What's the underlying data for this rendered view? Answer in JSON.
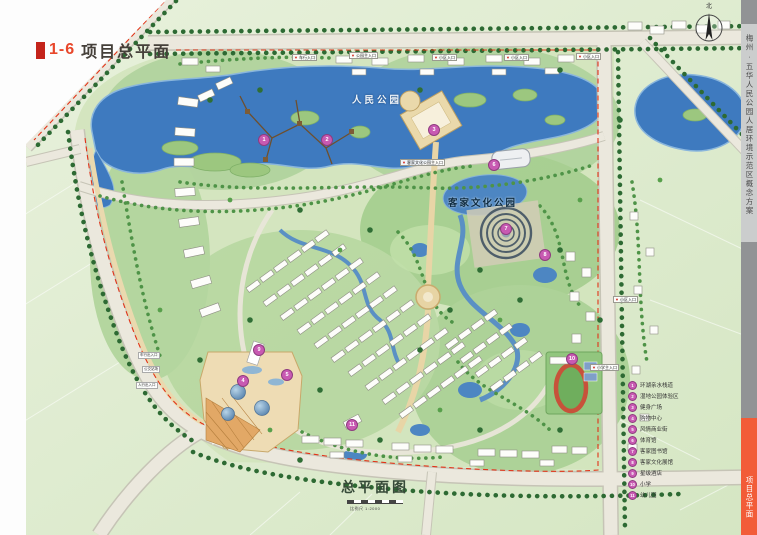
{
  "title": {
    "index": "1-6",
    "text": "项目总平面"
  },
  "sheet": {
    "plan_title": "总平面图",
    "scale_text": "比例尺 1:2000",
    "north_label": "北"
  },
  "sidebar": {
    "project_name": "梅州·五华人民公园人居环境示范区概念方案",
    "tab_label": "项目总平面",
    "accent_color": "#f25c38"
  },
  "map": {
    "park_label": "人民公园",
    "culture_park_label": "客家文化公园",
    "entrances": [
      {
        "text": "车行入口"
      },
      {
        "text": "公园主入口"
      },
      {
        "text": "小区入口"
      },
      {
        "text": "小区入口"
      },
      {
        "text": "小区入口"
      },
      {
        "text": "小区入口"
      },
      {
        "text": "小学主入口"
      },
      {
        "text": "客家文化公园主入口"
      }
    ],
    "side_labels": [
      "车行出入口",
      "公交站场",
      "人行出入口"
    ],
    "colors": {
      "water": "#3e7abf",
      "field": "#dcead0",
      "park": "#a6cf90",
      "road": "#ebe8dd",
      "tree": "#2d6a33",
      "marker": "#c85ab2",
      "boundary_dash": "#e23318",
      "title_red": "#e8472b"
    }
  },
  "legend": {
    "items": [
      {
        "num": "1",
        "label": "环湖亲水栈道"
      },
      {
        "num": "2",
        "label": "湿地公园体验区"
      },
      {
        "num": "3",
        "label": "健身广场"
      },
      {
        "num": "4",
        "label": "购物中心"
      },
      {
        "num": "5",
        "label": "风情商业街"
      },
      {
        "num": "6",
        "label": "体育馆"
      },
      {
        "num": "7",
        "label": "客家图书馆"
      },
      {
        "num": "8",
        "label": "客家文化展馆"
      },
      {
        "num": "9",
        "label": "星级酒店"
      },
      {
        "num": "10",
        "label": "小学"
      },
      {
        "num": "11",
        "label": "幼儿园"
      }
    ]
  }
}
